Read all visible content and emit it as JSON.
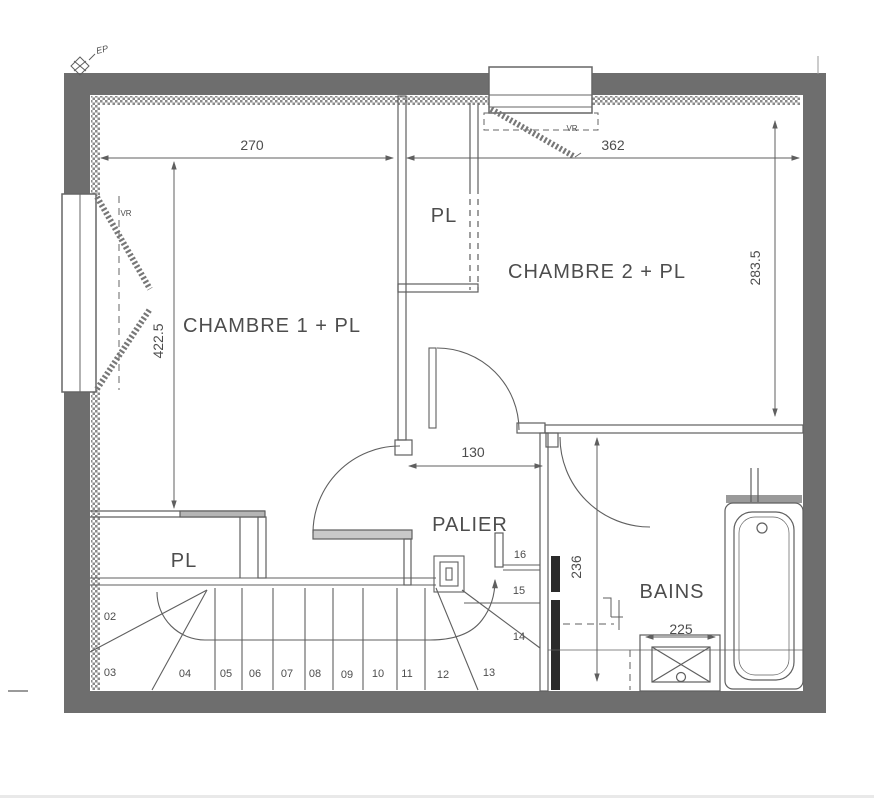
{
  "plan": {
    "rooms": {
      "chambre1": "CHAMBRE 1 + PL",
      "chambre2": "CHAMBRE 2 + PL",
      "palier": "PALIER",
      "bains": "BAINS",
      "closet_top": "PL",
      "closet_bottom": "PL"
    },
    "dimensions": {
      "top_left": "270",
      "top_right": "362",
      "right_vertical": "283.5",
      "left_vertical": "422.5",
      "opening": "130",
      "stair_vertical": "236",
      "sink": "225"
    },
    "annotations": {
      "ep": "EP",
      "vr_top_window": "VR",
      "vr_left_window": "VR"
    },
    "stair_steps": [
      "02",
      "03",
      "04",
      "05",
      "06",
      "07",
      "08",
      "09",
      "10",
      "11",
      "12",
      "13",
      "14",
      "15",
      "16"
    ],
    "colors": {
      "wall": "#6e6e6e",
      "line": "#5f5f5f",
      "text": "#4d4d4d",
      "hatch": "#8a8a8a"
    }
  }
}
